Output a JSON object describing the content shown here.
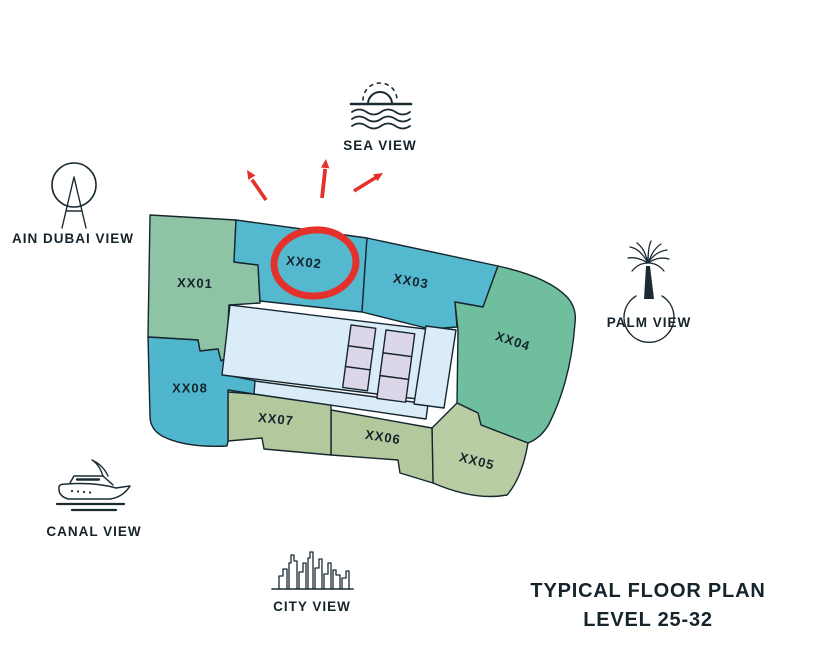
{
  "title": {
    "line1": "TYPICAL FLOOR PLAN",
    "line2": "LEVEL 25-32"
  },
  "views": [
    {
      "id": "sea",
      "label": "SEA VIEW"
    },
    {
      "id": "ain-dubai",
      "label": "AIN DUBAI VIEW"
    },
    {
      "id": "palm",
      "label": "PALM VIEW"
    },
    {
      "id": "canal",
      "label": "CANAL VIEW"
    },
    {
      "id": "city",
      "label": "CITY VIEW"
    }
  ],
  "plan": {
    "units": [
      {
        "id": "XX01",
        "label": "XX01",
        "color": "#8FC3A6",
        "highlighted": false
      },
      {
        "id": "XX02",
        "label": "XX02",
        "color": "#54B8CF",
        "highlighted": true
      },
      {
        "id": "XX03",
        "label": "XX03",
        "color": "#54B8CF",
        "highlighted": false
      },
      {
        "id": "XX04",
        "label": "XX04",
        "color": "#6FBF9F",
        "highlighted": false
      },
      {
        "id": "XX05",
        "label": "XX05",
        "color": "#B9CCA4",
        "highlighted": false
      },
      {
        "id": "XX06",
        "label": "XX06",
        "color": "#B3C99D",
        "highlighted": false
      },
      {
        "id": "XX07",
        "label": "XX07",
        "color": "#B3C99D",
        "highlighted": false
      },
      {
        "id": "XX08",
        "label": "XX08",
        "color": "#4FB6CE",
        "highlighted": false
      }
    ],
    "core_color": "#DAECF8",
    "elevator_color": "#DBD6E8",
    "outline_color": "#16262E",
    "highlight_color": "#E5312B"
  }
}
